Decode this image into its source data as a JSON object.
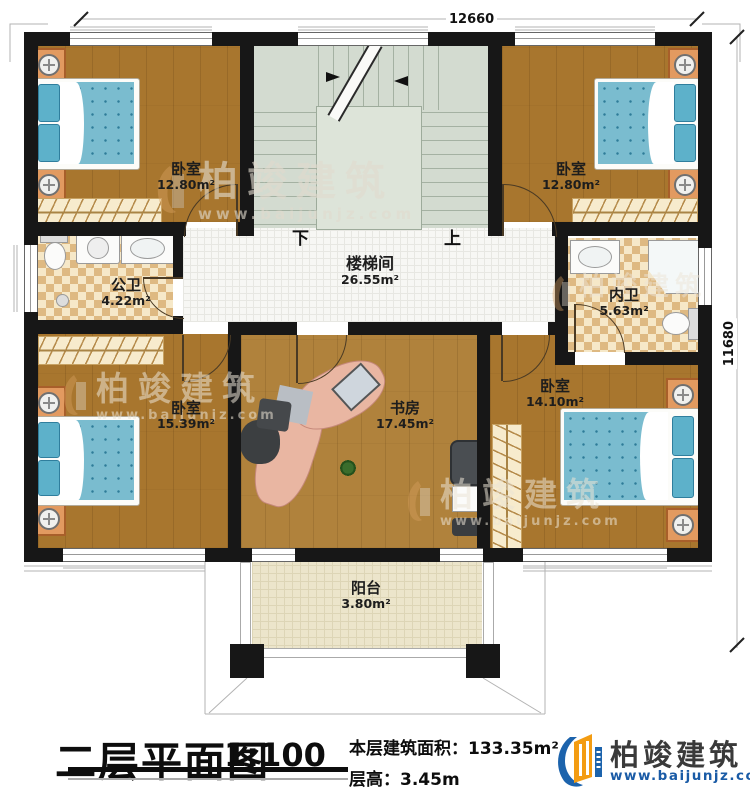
{
  "plan": {
    "dimensions": {
      "top": "12660",
      "right": "11680"
    },
    "stair": {
      "down": "下",
      "up": "上"
    },
    "rooms": [
      {
        "id": "bedroom-top-left",
        "name": "卧室",
        "area": "12.80m²"
      },
      {
        "id": "bedroom-top-right",
        "name": "卧室",
        "area": "12.80m²"
      },
      {
        "id": "public-bath",
        "name": "公卫",
        "area": "4.22m²"
      },
      {
        "id": "stairwell",
        "name": "楼梯间",
        "area": "26.55m²"
      },
      {
        "id": "private-bath",
        "name": "内卫",
        "area": "5.63m²"
      },
      {
        "id": "bedroom-bottom-left",
        "name": "卧室",
        "area": "15.39m²"
      },
      {
        "id": "study",
        "name": "书房",
        "area": "17.45m²"
      },
      {
        "id": "bedroom-bottom-right",
        "name": "卧室",
        "area": "14.10m²"
      },
      {
        "id": "balcony",
        "name": "阳台",
        "area": "3.80m²"
      }
    ],
    "watermark": {
      "brand": "柏竣建筑",
      "url": "www.baijunjz.com"
    }
  },
  "footer": {
    "title": "二层平面图",
    "scale": "1:100",
    "area_label": "本层建筑面积：",
    "area_value": "133.35m²",
    "height_label": "层高：",
    "height_value": "3.45m",
    "brand": "柏竣建筑",
    "brand_url": "www.baijunjz.com"
  },
  "colors": {
    "wall": "#171717",
    "wood": "#a8762e",
    "mattress_blue": "#7abccf",
    "bath_tile": "#e9c98f",
    "brand_blue": "#1c63ac",
    "brand_orange": "#f39c12"
  }
}
